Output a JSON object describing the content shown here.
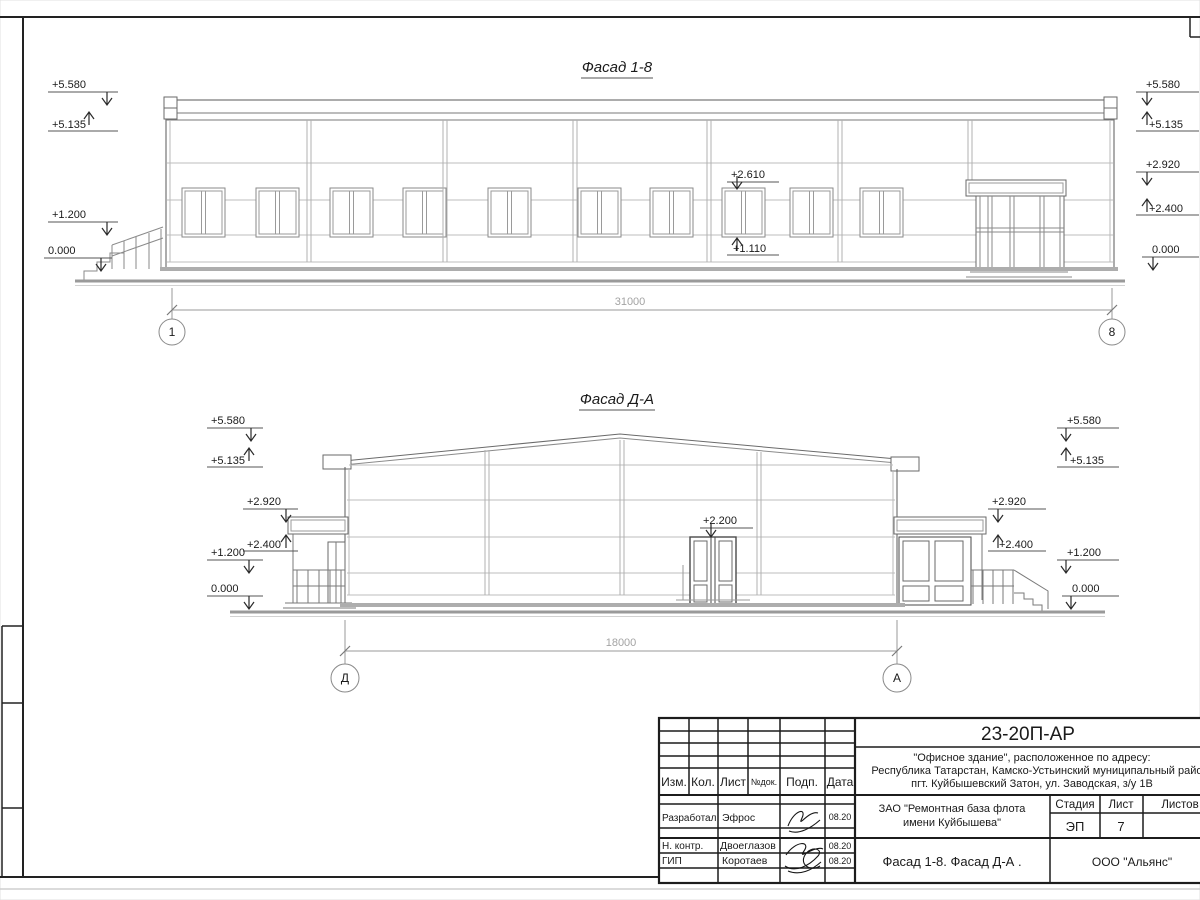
{
  "facade_top": {
    "title": "Фасад 1-8",
    "dim": "31000",
    "axis_left": "1",
    "axis_right": "8",
    "marks": {
      "left": [
        "+5.580",
        "+5.135",
        "+1.200",
        "0.000"
      ],
      "right": [
        "+5.580",
        "+5.135",
        "+2.920",
        "+2.400",
        "0.000"
      ],
      "window_top": "+2.610",
      "window_bottom": "+1.110"
    }
  },
  "facade_bottom": {
    "title": "Фасад Д-А",
    "dim": "18000",
    "axis_left": "Д",
    "axis_right": "А",
    "marks": {
      "left": [
        "+5.580",
        "+5.135",
        "+2.920",
        "+2.400",
        "+1.200",
        "0.000"
      ],
      "right_inner": [
        "+2.920",
        "+2.400"
      ],
      "right": [
        "+5.580",
        "+5.135",
        "+1.200",
        "0.000"
      ],
      "door": "+2.200"
    }
  },
  "stamp": {
    "doc_code": "23-20П-АР",
    "object_line1": "\"Офисное здание\", расположенное по адресу:",
    "object_line2": "Республика Татарстан, Камско-Устьинский муниципальный район",
    "object_line3": "пгт. Куйбышевский Затон, ул. Заводская, з/у 1В",
    "client_line1": "ЗАО \"Ремонтная база флота",
    "client_line2": "имени Куйбышева\"",
    "sheet_title": "Фасад 1-8. Фасад Д-А .",
    "org": "ООО \"Альянс\"",
    "stage_label": "Стадия",
    "sheet_label": "Лист",
    "sheets_label": "Листов",
    "stage_value": "ЭП",
    "sheet_value": "7",
    "cols": {
      "izm": "Изм.",
      "kol": "Кол.",
      "list": "Лист",
      "ndok": "№док.",
      "podp": "Подп.",
      "data": "Дата"
    },
    "rows": [
      {
        "role": "Разработал",
        "name": "Эфрос",
        "date": "08.20"
      },
      {
        "role": "Н. контр.",
        "name": "Двоеглазов",
        "date": "08.20"
      },
      {
        "role": "ГИП",
        "name": "Коротаев",
        "date": "08.20"
      }
    ]
  }
}
